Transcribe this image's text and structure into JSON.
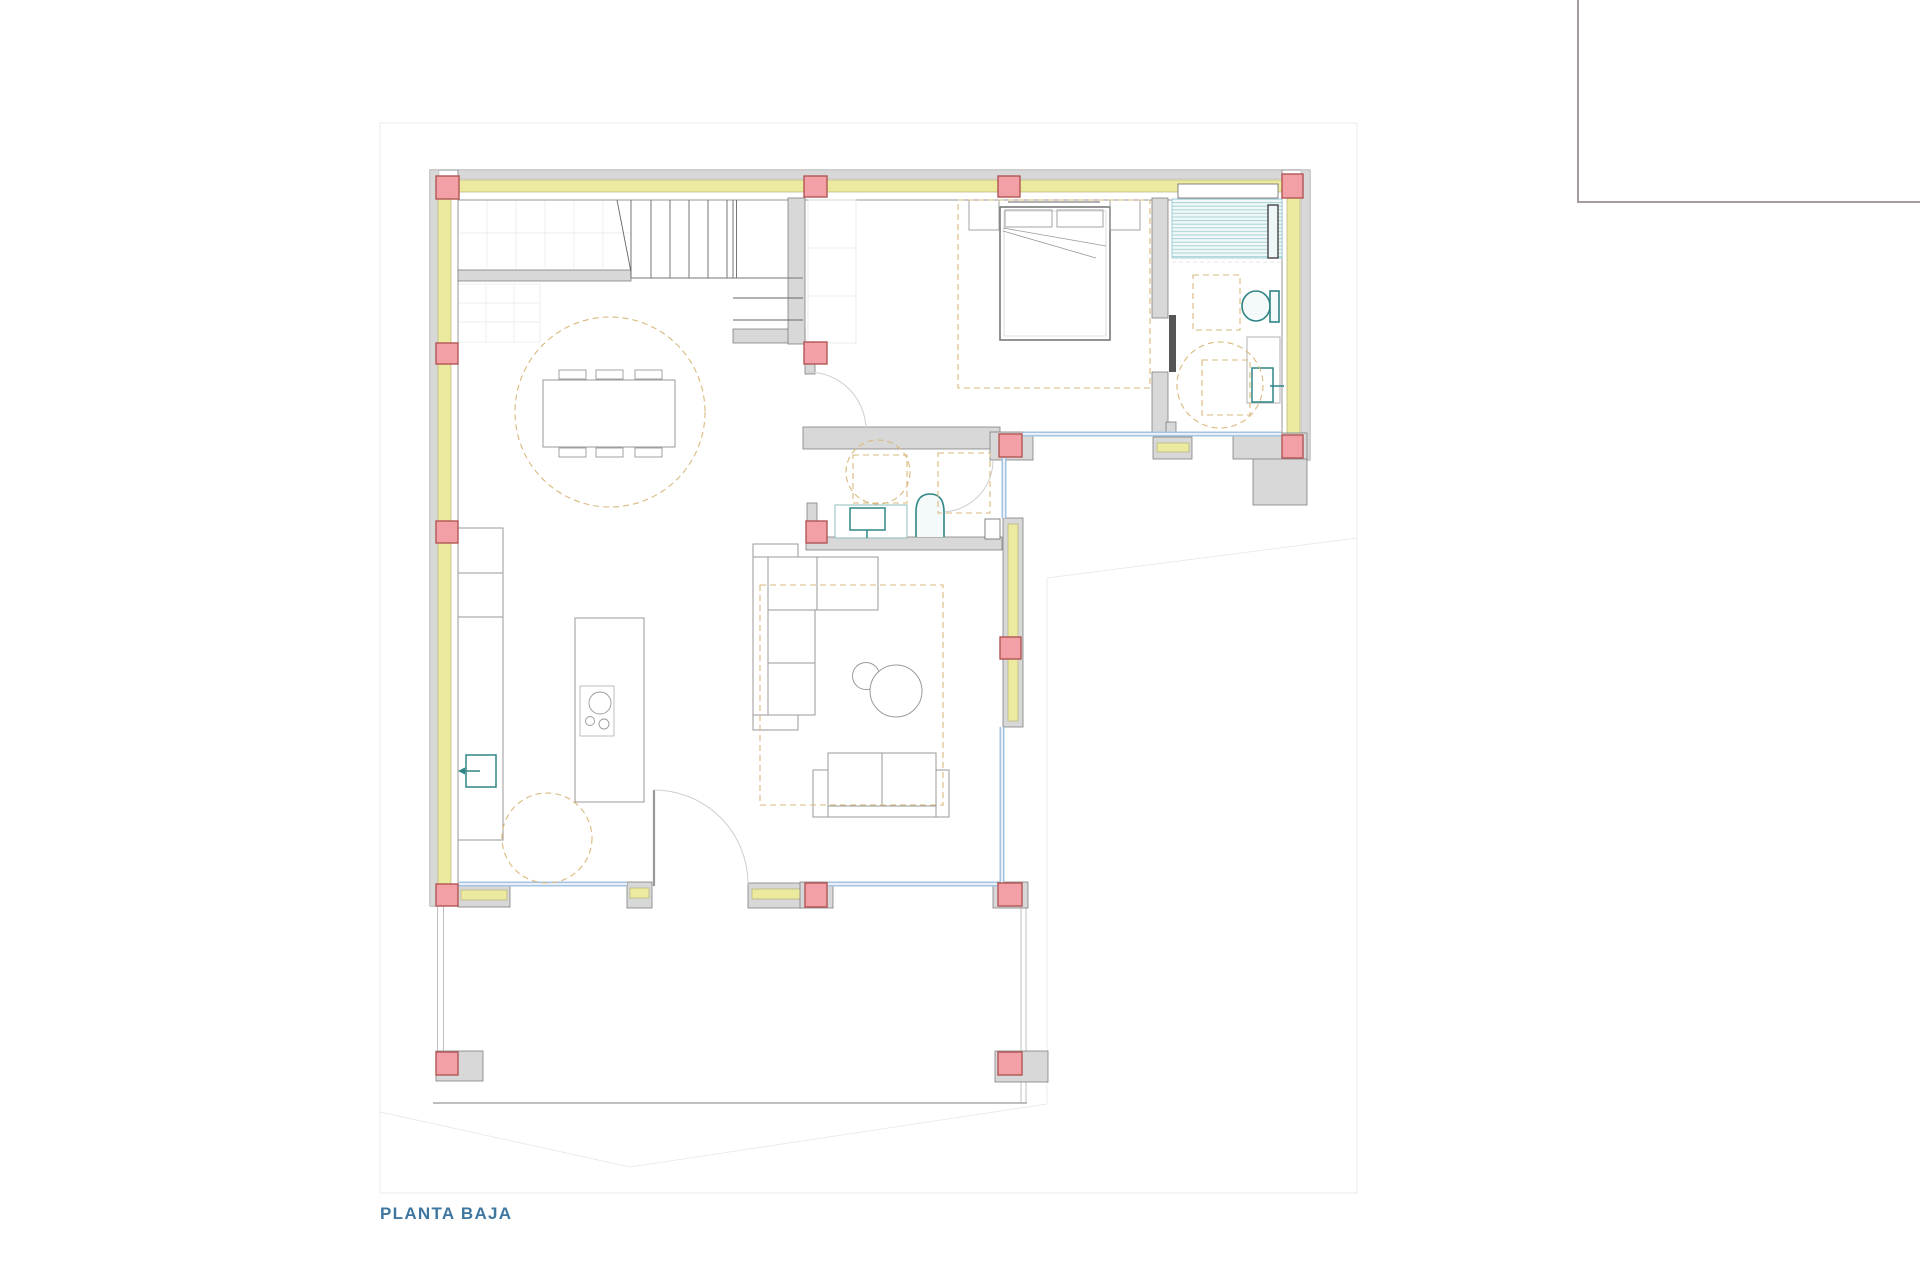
{
  "sheet": {
    "title": "PLANTA BAJA"
  },
  "colors": {
    "title_blue": "#3f76a0",
    "column_pink": "#f2a0a6",
    "column_border": "#b25555",
    "wall_gray": "#d8d8d8",
    "wall_edge": "#8c8c8c",
    "insulation_yellow": "#ecea9e",
    "insulation_edge": "#b3b378",
    "glazing_blue": "#a6c4e2",
    "fixture_teal": "#2f8585",
    "guide_dash_orange": "#d9b97e",
    "frame_gray": "#a89aa0"
  }
}
